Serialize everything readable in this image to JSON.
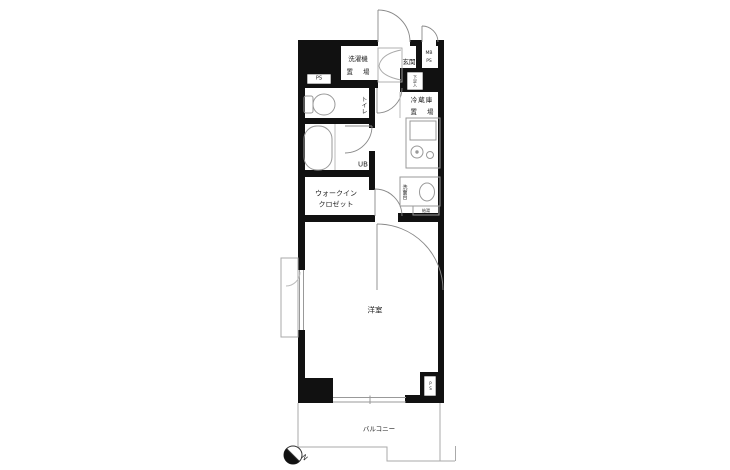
{
  "floorplan": {
    "type": "apartment-floor-plan-1K",
    "labels": {
      "washer_place": {
        "line1": "洗濯機",
        "line2": "置 場"
      },
      "pipe_space_top": "PS",
      "entrance": "玄関",
      "meter_box": {
        "line1": "MB",
        "line2": "PS"
      },
      "shoe_box": "下足入",
      "toilet": "トイレ",
      "fridge_place": {
        "line1": "冷蔵庫",
        "line2": "置 場"
      },
      "unit_bath": "UB",
      "washstand": "洗面台",
      "water_heater": "給湯",
      "walk_in_closet": {
        "line1": "ウォークイン",
        "line2": "クロゼット"
      },
      "western_room": "洋室",
      "pipe_space_bottom": "PS",
      "balcony": "バルコニー",
      "north_mark": "N"
    },
    "colors": {
      "wall": "#111111",
      "fixture_line": "#999999",
      "door_line": "#888888",
      "outline": "#aaaaaa",
      "background": "#ffffff"
    }
  }
}
